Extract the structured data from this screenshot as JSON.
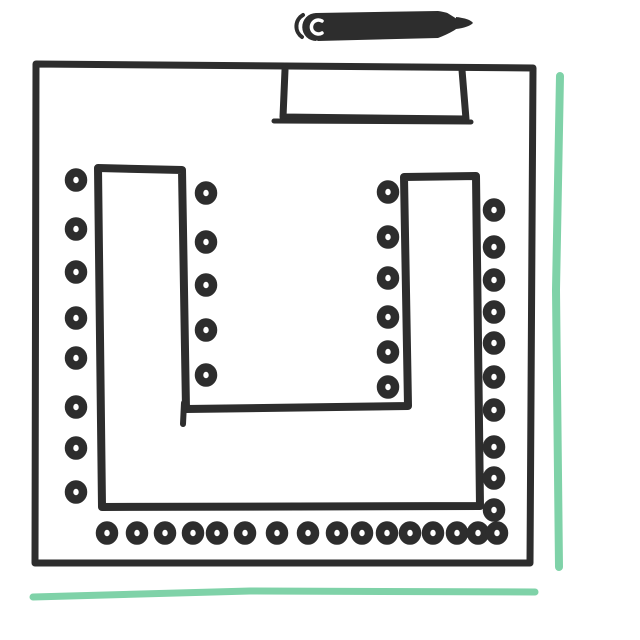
{
  "sketch": {
    "background": "#ffffff",
    "ink_color": "#2d2d2d",
    "accent_color": "#7fd2a8",
    "canvas": {
      "width": 640,
      "height": 640
    },
    "shapes": [
      {
        "name": "room-outline",
        "type": "polygon",
        "stroke": "ink",
        "width": 7,
        "points": [
          [
            36,
            64
          ],
          [
            533,
            68
          ],
          [
            530,
            563
          ],
          [
            35,
            563
          ]
        ]
      },
      {
        "name": "front-board-rectangle",
        "type": "polyline",
        "stroke": "ink",
        "width": 7,
        "points": [
          [
            285,
            70
          ],
          [
            283,
            117
          ],
          [
            466,
            119
          ],
          [
            462,
            70
          ]
        ]
      },
      {
        "name": "front-board-underline",
        "type": "polyline",
        "stroke": "ink",
        "width": 5,
        "points": [
          [
            274,
            121
          ],
          [
            471,
            122
          ]
        ]
      },
      {
        "name": "u-table-outline",
        "type": "polygon",
        "stroke": "ink",
        "width": 8,
        "points": [
          [
            98,
            168
          ],
          [
            102,
            507
          ],
          [
            480,
            506
          ],
          [
            476,
            176
          ],
          [
            404,
            177
          ],
          [
            408,
            406
          ],
          [
            186,
            409
          ],
          [
            182,
            170
          ]
        ]
      },
      {
        "name": "u-table-inner-overshoot",
        "type": "polyline",
        "stroke": "ink",
        "width": 6,
        "points": [
          [
            184,
            403
          ],
          [
            183,
            424
          ]
        ]
      },
      {
        "name": "accent-line-right",
        "type": "polyline",
        "stroke": "accent",
        "width": 8,
        "points": [
          [
            560,
            76
          ],
          [
            556,
            290
          ],
          [
            559,
            567
          ]
        ]
      },
      {
        "name": "accent-line-bottom",
        "type": "polyline",
        "stroke": "accent",
        "width": 7,
        "points": [
          [
            33,
            597
          ],
          [
            250,
            591
          ],
          [
            535,
            592
          ]
        ]
      }
    ],
    "marker_doodle": {
      "name": "marker-pen-doodle-icon",
      "paths": [
        {
          "d": "M303,15 A13,13 0 0,0 302,37",
          "stroke": "ink",
          "width": 4
        },
        {
          "d": "M316,13 L438,11 C452,13 459,17 466,22 C459,28 449,34 438,38 L318,41 C311,38 310,16 316,13 Z",
          "fill": "ink"
        },
        {
          "d": "M316,13 a14,14 0 1,0 0.5,28 Z",
          "fill": "ink"
        },
        {
          "d": "M322,21 a7,7 0 1,0 0,12",
          "stroke": "#ffffff",
          "width": 3.5
        },
        {
          "d": "M441,9 L467,7 L457,19 Z",
          "fill": "#ffffff"
        },
        {
          "d": "M443,43 L469,39 L457,28 Z",
          "fill": "#ffffff"
        },
        {
          "d": "M456,17 C465,18 471,20 473,23 C470,26 464,28 456,29 Z",
          "fill": "ink"
        }
      ]
    },
    "seats": {
      "total": 45,
      "dot_radius_x": 7,
      "dot_radius_y": 7.5,
      "dot_stroke_width": 8.5,
      "groups": [
        {
          "id": "left-wall",
          "axis": "vertical",
          "x": 76,
          "positions": [
            180,
            229,
            272,
            318,
            358,
            407,
            448,
            492
          ]
        },
        {
          "id": "inner-left",
          "axis": "vertical",
          "x": 206,
          "positions": [
            193,
            242,
            285,
            330,
            375
          ]
        },
        {
          "id": "inner-right",
          "axis": "vertical",
          "x": 388,
          "positions": [
            192,
            237,
            278,
            317,
            352,
            387
          ]
        },
        {
          "id": "right-wall",
          "axis": "vertical",
          "x": 494,
          "positions": [
            210,
            247,
            280,
            312,
            343,
            377,
            410,
            447,
            478,
            510
          ]
        },
        {
          "id": "bottom-row",
          "axis": "horizontal",
          "y": 533,
          "positions": [
            107,
            137,
            165,
            193,
            217,
            245,
            277,
            308,
            337,
            362,
            387,
            410,
            433,
            457,
            478,
            497
          ]
        }
      ]
    }
  }
}
